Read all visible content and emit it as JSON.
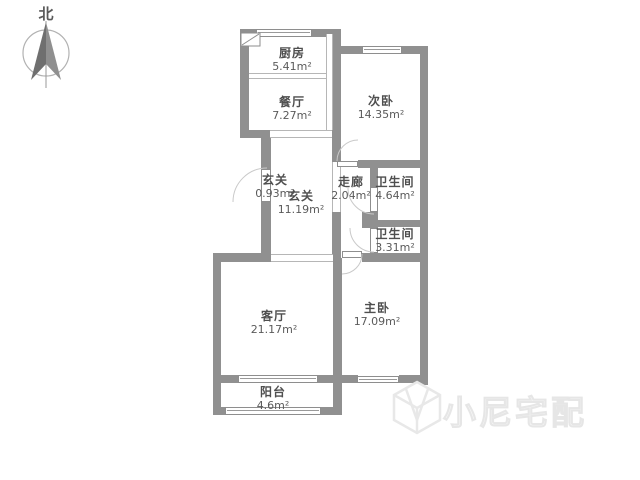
{
  "compass": {
    "label": "北"
  },
  "rooms": [
    {
      "id": "kitchen",
      "name": "厨房",
      "area": "5.41m²"
    },
    {
      "id": "dining",
      "name": "餐厅",
      "area": "7.27m²"
    },
    {
      "id": "bedroom2",
      "name": "次卧",
      "area": "14.35m²"
    },
    {
      "id": "foyer-small",
      "name": "玄关",
      "area": "0.93m²"
    },
    {
      "id": "foyer",
      "name": "玄关",
      "area": "11.19m²"
    },
    {
      "id": "corridor",
      "name": "走廊",
      "area": "2.04m²"
    },
    {
      "id": "bathroom-1",
      "name": "卫生间",
      "area": "4.64m²"
    },
    {
      "id": "bathroom-2",
      "name": "卫生间",
      "area": "3.31m²"
    },
    {
      "id": "living-room",
      "name": "客厅",
      "area": "21.17m²"
    },
    {
      "id": "master-bedroom",
      "name": "主卧",
      "area": "17.09m²"
    },
    {
      "id": "balcony",
      "name": "阳台",
      "area": "4.6m²"
    }
  ],
  "watermark": {
    "text": "小尼宅配"
  },
  "colors": {
    "wall": "#909090",
    "thin_line": "#b6b6b6",
    "door_arc": "#c9c9c9",
    "text": "#4f4f4f",
    "watermark": "#e6e6e6"
  }
}
